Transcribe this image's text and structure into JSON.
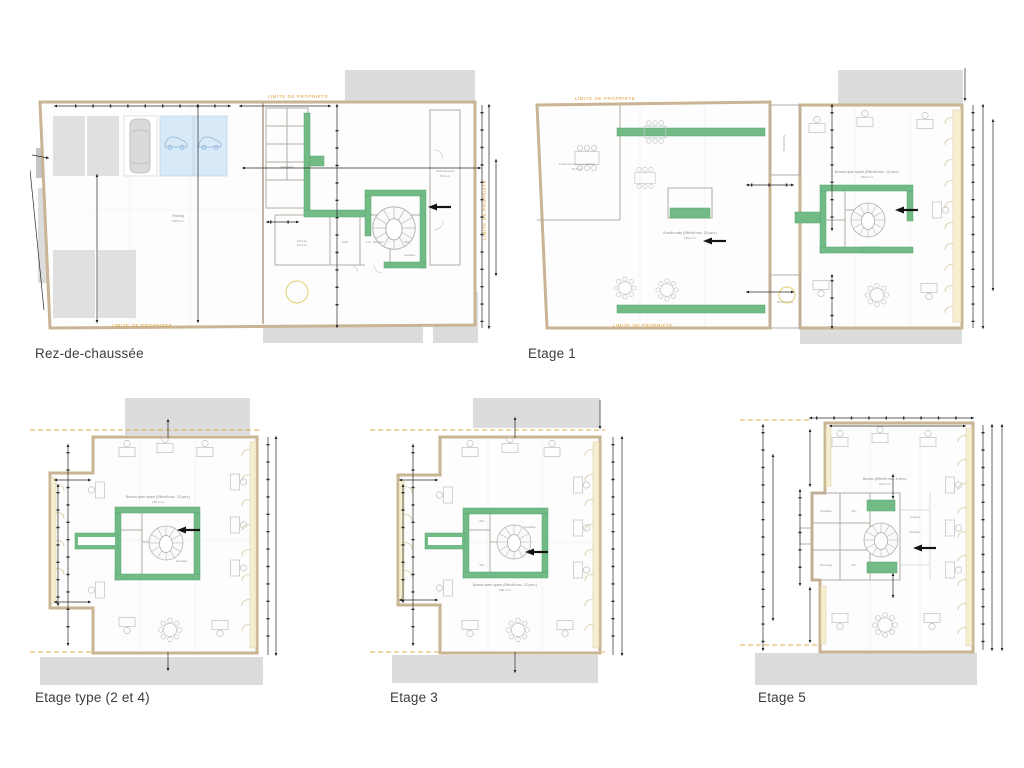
{
  "sheet": {
    "background": "#ffffff",
    "type": "architectural-floorplans"
  },
  "plans": {
    "rdc": {
      "title": "Rez-de-chaussée"
    },
    "e1": {
      "title": "Etage 1"
    },
    "e24": {
      "title": "Etage type (2 et 4)"
    },
    "e3": {
      "title": "Etage 3"
    },
    "e5": {
      "title": "Etage 5"
    }
  },
  "ann": {
    "limite": "LIMITE DE PROPRIETE",
    "terrasse": "TERRASSE",
    "parking": "Parking",
    "parking_area": "182,5 m²",
    "open_space": "Bureau open space (Effectif max. 22 pers.)",
    "open_space_area": "180,2 m²",
    "salle": "Grande salle (Effectif max. 32 pers.)",
    "salle_area": "140,2 m²",
    "local_tech": "Local technique ventilation",
    "local_tech_area": "31,5 m²",
    "hall": "Hall d'accueil",
    "hall_area": "15,3 m²",
    "vestiaires": "Vestiaires",
    "vestiaire": "Vestiaire",
    "fitness": "Fitness",
    "fitness_area": "13,5 m²",
    "sas": "SAS",
    "dechets": "Loc. déchets",
    "wc": "WC",
    "cuisine": "Cuisine",
    "dressing": "Dressing",
    "escalier": "Escalier",
    "bureau5": "Bureau (Effectif max. 4 pers.)",
    "bureau5_area": "110,2 m²"
  },
  "colors": {
    "green_wall": "#72bb86",
    "orange_accent": "#e2a13a",
    "parking_blue": "#d8e9f7",
    "neighbor_gray": "#dcdcdc",
    "wall_tan": "#c9b494",
    "window_cream": "#f5eecf",
    "dimension_black": "#2a2a2a"
  }
}
